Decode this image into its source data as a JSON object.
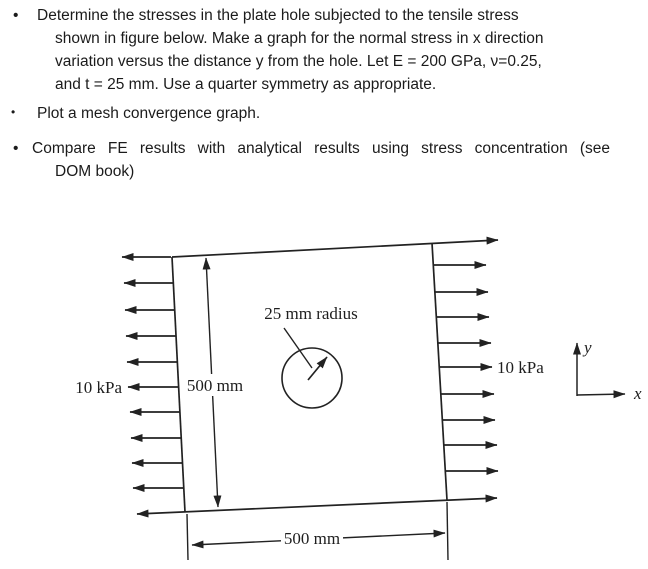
{
  "problem": {
    "bullets": [
      {
        "marker": "•",
        "lines": [
          "Determine the stresses in the plate hole subjected to the tensile stress",
          "shown in figure below. Make a graph for the normal stress in x direction",
          "variation versus the distance y from the hole. Let E = 200 GPa, ν=0.25,",
          "and t = 25 mm. Use a quarter symmetry as appropriate."
        ]
      },
      {
        "marker": "•",
        "lines": [
          "Plot a mesh convergence graph."
        ]
      },
      {
        "marker": "•",
        "lines": [
          "Compare FE results with analytical results using stress concentration (see",
          "DOM book)"
        ]
      }
    ]
  },
  "figure": {
    "hole_label": "25 mm radius",
    "height_dim_label": "500 mm",
    "width_dim_label": "500 mm",
    "left_load_label": "10 kPa",
    "right_load_label": "10 kPa",
    "axis_x_label": "x",
    "axis_y_label": "y",
    "left_arrow_count": 11,
    "right_arrow_count": 11,
    "ink_color": "#222222",
    "background_color": "#ffffff"
  }
}
